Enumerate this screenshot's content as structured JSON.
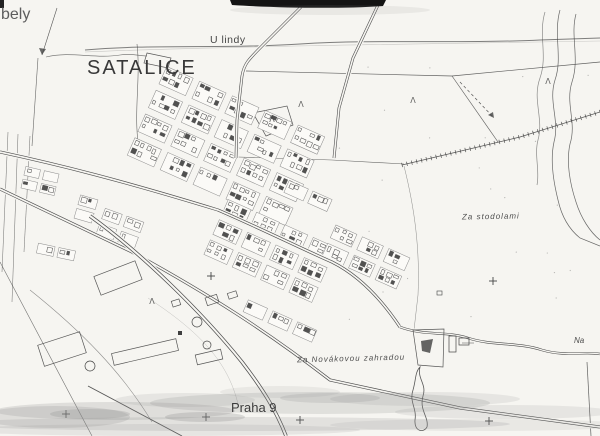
{
  "map": {
    "labels": {
      "corner": "bely",
      "u_lindy": "U lindy",
      "title": "SATALICE",
      "za_stodolami": "Za stodolami",
      "za_novakovou": "Za Novákovou zahradou",
      "praha": "Praha 9",
      "na": "Na"
    },
    "grid_crosses": [
      [
        211,
        276
      ],
      [
        493,
        281
      ],
      [
        66,
        414
      ],
      [
        206,
        417
      ],
      [
        300,
        420
      ],
      [
        489,
        421
      ]
    ],
    "tree_symbols": [
      [
        301,
        107
      ],
      [
        413,
        103
      ],
      [
        548,
        84
      ],
      [
        152,
        304
      ],
      [
        272,
        122
      ]
    ],
    "symbol_glyph": "Λ",
    "colors": {
      "ink": "#454545",
      "paper": "#f6f5f1",
      "block": "#fbfaf7",
      "smudge": "#8c8c8c",
      "scan_black": "#141414"
    }
  }
}
